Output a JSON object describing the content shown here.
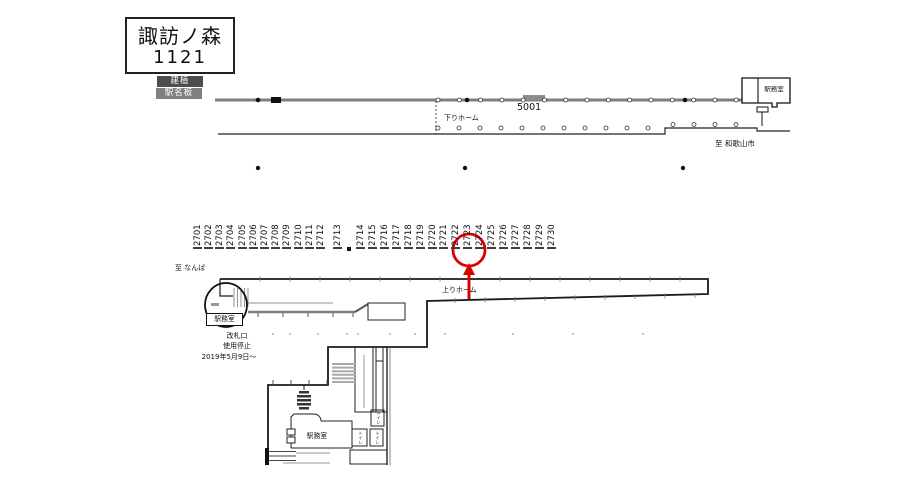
{
  "title_box": {
    "station_name": "諏訪ノ森",
    "station_code": "1121"
  },
  "badges": {
    "top": "建植",
    "bottom": "駅名板"
  },
  "upper_diagram": {
    "platform_label": "下りホーム",
    "car_stop_sign": "5001",
    "office_label": "駅務室",
    "direction_right": "至 和歌山市"
  },
  "lower_diagram": {
    "direction_left": "至 なんば",
    "platform_label": "上りホーム",
    "circled_office_label": "駅務室",
    "closure_note_line1": "改札口",
    "closure_note_line2": "使用停止",
    "closure_note_line3": "2019年5月9日～",
    "room_office_label": "駅務室",
    "toilet_label": "トイレ",
    "ad_numbers_group1": [
      "2701",
      "2702",
      "2703",
      "2704",
      "2705",
      "2706",
      "2707",
      "2708",
      "2709",
      "2710",
      "2711",
      "2712",
      "2713"
    ],
    "ad_numbers_group2": [
      "2714",
      "2715",
      "2716",
      "2717",
      "2718",
      "2719",
      "2720",
      "2721",
      "2722",
      "2723",
      "2724",
      "2725",
      "2726",
      "2727",
      "2728",
      "2729",
      "2730"
    ],
    "highlighted_number": "2723"
  },
  "annotation": {
    "shape": "red-circle-with-up-arrow",
    "target_number": "2723"
  },
  "icons": {
    "station_sign": "station-sign-icon",
    "stairs": "stairs-icon",
    "door": "door-arc-icon"
  },
  "colors": {
    "accent_red": "#dd0000",
    "platform_gray": "#7f7f7f",
    "badge_dark": "#4d4d4d",
    "badge_mid": "#808080"
  }
}
